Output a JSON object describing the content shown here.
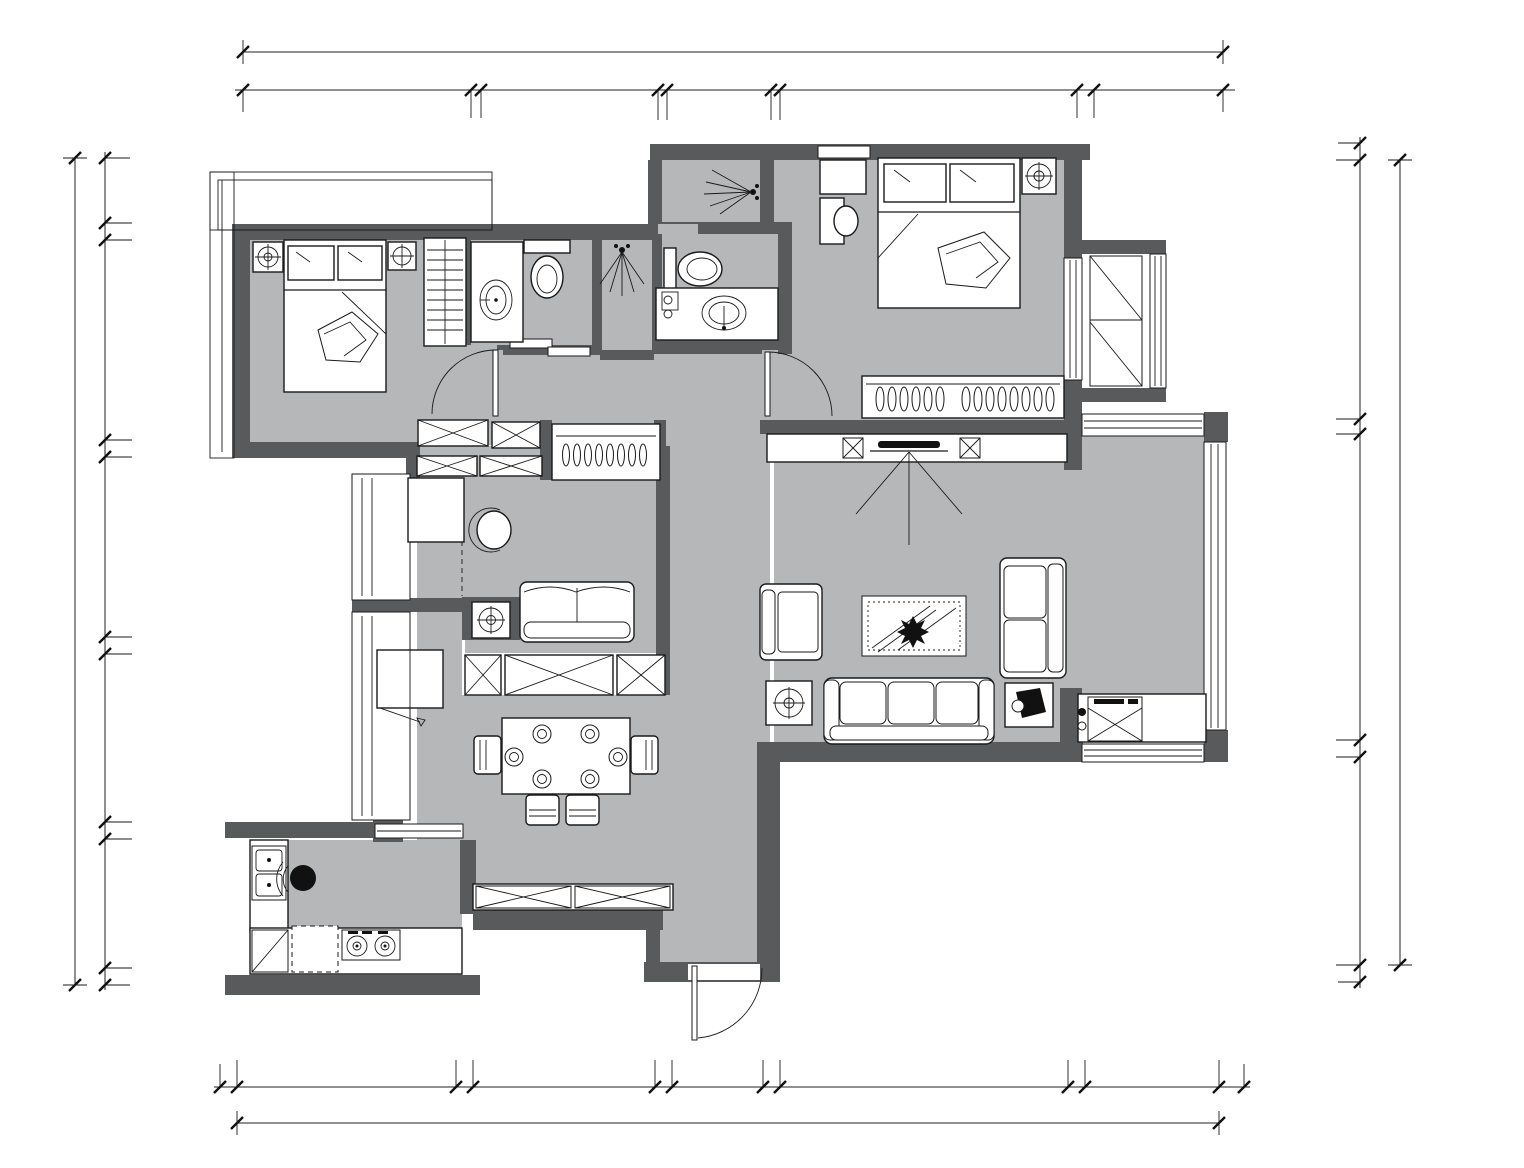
{
  "colors": {
    "wall": "#595a5c",
    "floor": "#b5b7b9",
    "line": "#1a1a1a",
    "background": "#ffffff"
  },
  "rooms": {
    "secondary_bedroom": "次卧",
    "public_bath": "公卫",
    "shower": "淋浴房",
    "master_bath": "主卫",
    "master_bedroom": "主卧",
    "study": "书房",
    "living_room": "客厅",
    "balcony": "生活阳台",
    "dining_room": "餐厅",
    "kitchen": "厨房"
  },
  "fixtures": {
    "fridge": "冰箱",
    "wine_cabinet": "酒柜",
    "shoe_cabinet": "鞋柜",
    "washing_machine": "洗衣机",
    "dishwasher": "洗碗机"
  },
  "dims": {
    "top": {
      "total": "13725",
      "segments": [
        "3190",
        "140",
        "2480",
        "130",
        "1460",
        "120",
        "4160",
        "240",
        "1805"
      ]
    },
    "bottom": {
      "total": "13740",
      "segments": [
        "240",
        "3060",
        "240",
        "2550",
        "240",
        "1270",
        "240",
        "4030",
        "240",
        "1870",
        "350"
      ]
    },
    "left": {
      "total": "11760",
      "segments": [
        "930",
        "240",
        "2840",
        "240",
        "2560",
        "240",
        "2395",
        "240",
        "1835",
        "240"
      ]
    },
    "right": {
      "total": "11450",
      "segments": [
        "240",
        "3680",
        "220",
        "4350",
        "240",
        "2960",
        "240"
      ]
    }
  }
}
